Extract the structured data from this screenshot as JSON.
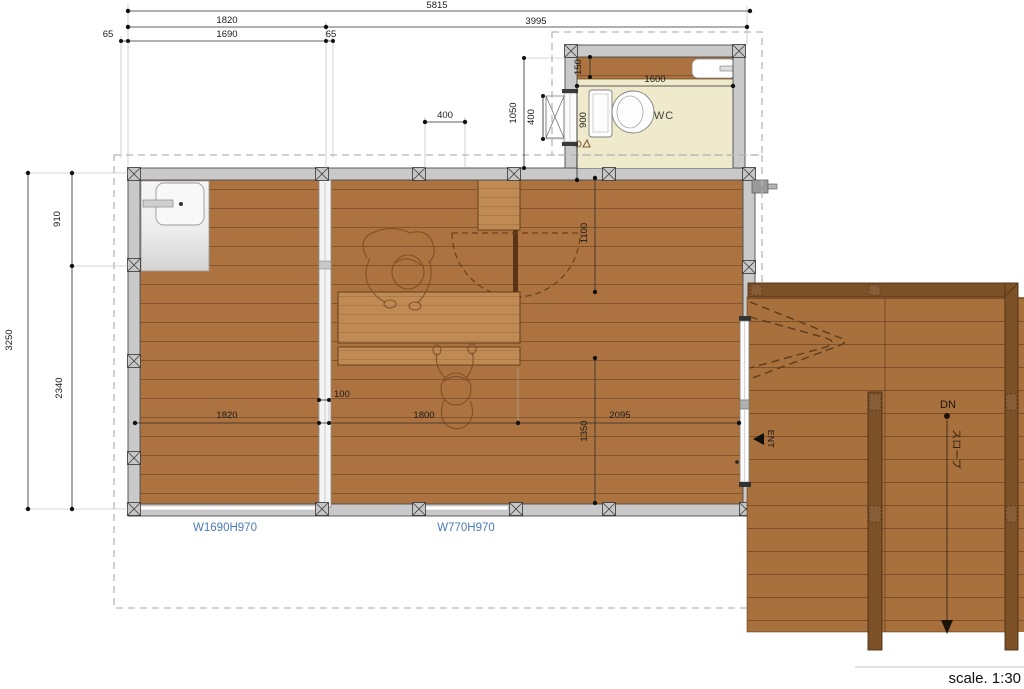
{
  "labels": {
    "wc": "WC",
    "ent": "ENT",
    "dn": "DN",
    "slope": "スロープ",
    "window_left": "W1690H970",
    "window_center": "W770H970",
    "scale": "scale. 1:30"
  },
  "dims": {
    "overall_width": "5815",
    "bay_left": "1820",
    "bay_right": "3995",
    "eave_left": "65",
    "window_width": "1690",
    "eave_right": "65",
    "top_400": "400",
    "wc_shelf_depth": "150",
    "wc_inner_width": "1600",
    "wc_inner_depth": "900",
    "lift_clear": "1050",
    "lift_door": "400",
    "opening_width": "1100",
    "partition_gap": "100",
    "room_left_width": "1820",
    "room_mid_width": "1800",
    "room_right_width": "2095",
    "mid_depth": "1350",
    "side_overall": "3250",
    "side_top": "910",
    "side_bottom": "2340"
  },
  "colors": {
    "floor_wood": "#ac7340",
    "furniture_wood": "#c08a55",
    "deck_wood": "#a8703d",
    "deck_rail": "#7d5128",
    "wall_gray": "#c9c9c9",
    "wc_floor": "#eeeacb",
    "window_label_blue": "#4b79bd",
    "sketch_brown": "#7d4e24"
  }
}
